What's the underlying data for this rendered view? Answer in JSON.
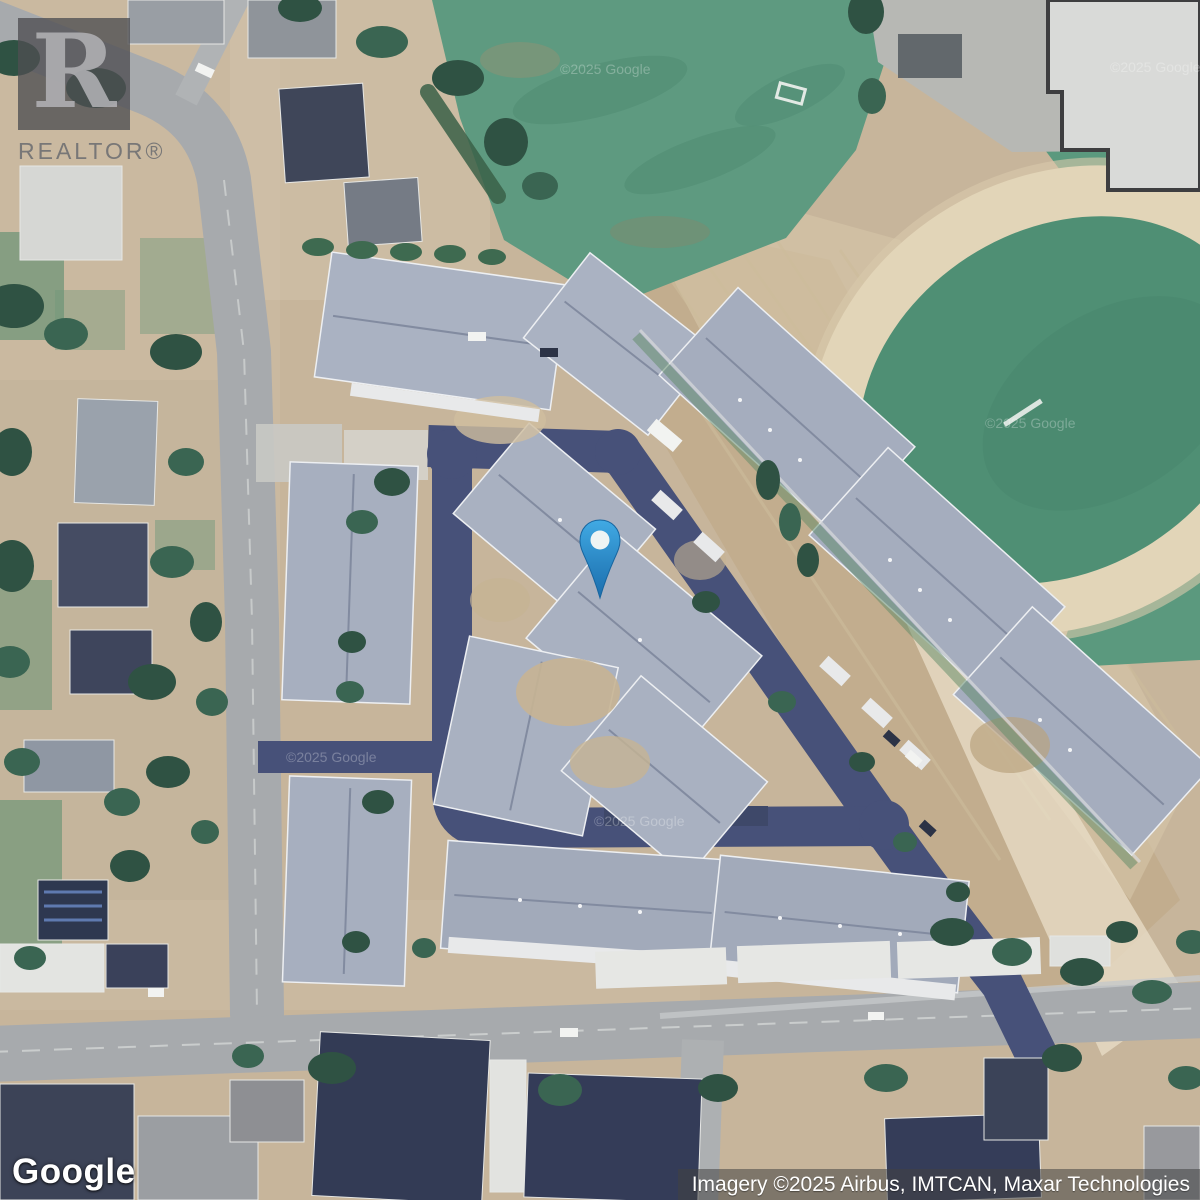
{
  "map": {
    "view_type": "satellite",
    "attribution": "Imagery ©2025 Airbus, IMTCAN, Maxar Technologies",
    "google_watermark": "©2025 Google",
    "pin_color": "#2f93cf",
    "private_road_color": "#475179",
    "public_road_color": "#a7aaad",
    "field_green_color": "#5e9a80",
    "dirt_color": "#c7b59b",
    "roof_color": "#a9b1c1"
  },
  "branding": {
    "realtor_letter": "R",
    "realtor_label": "REALTOR®",
    "google_label": "Google"
  }
}
